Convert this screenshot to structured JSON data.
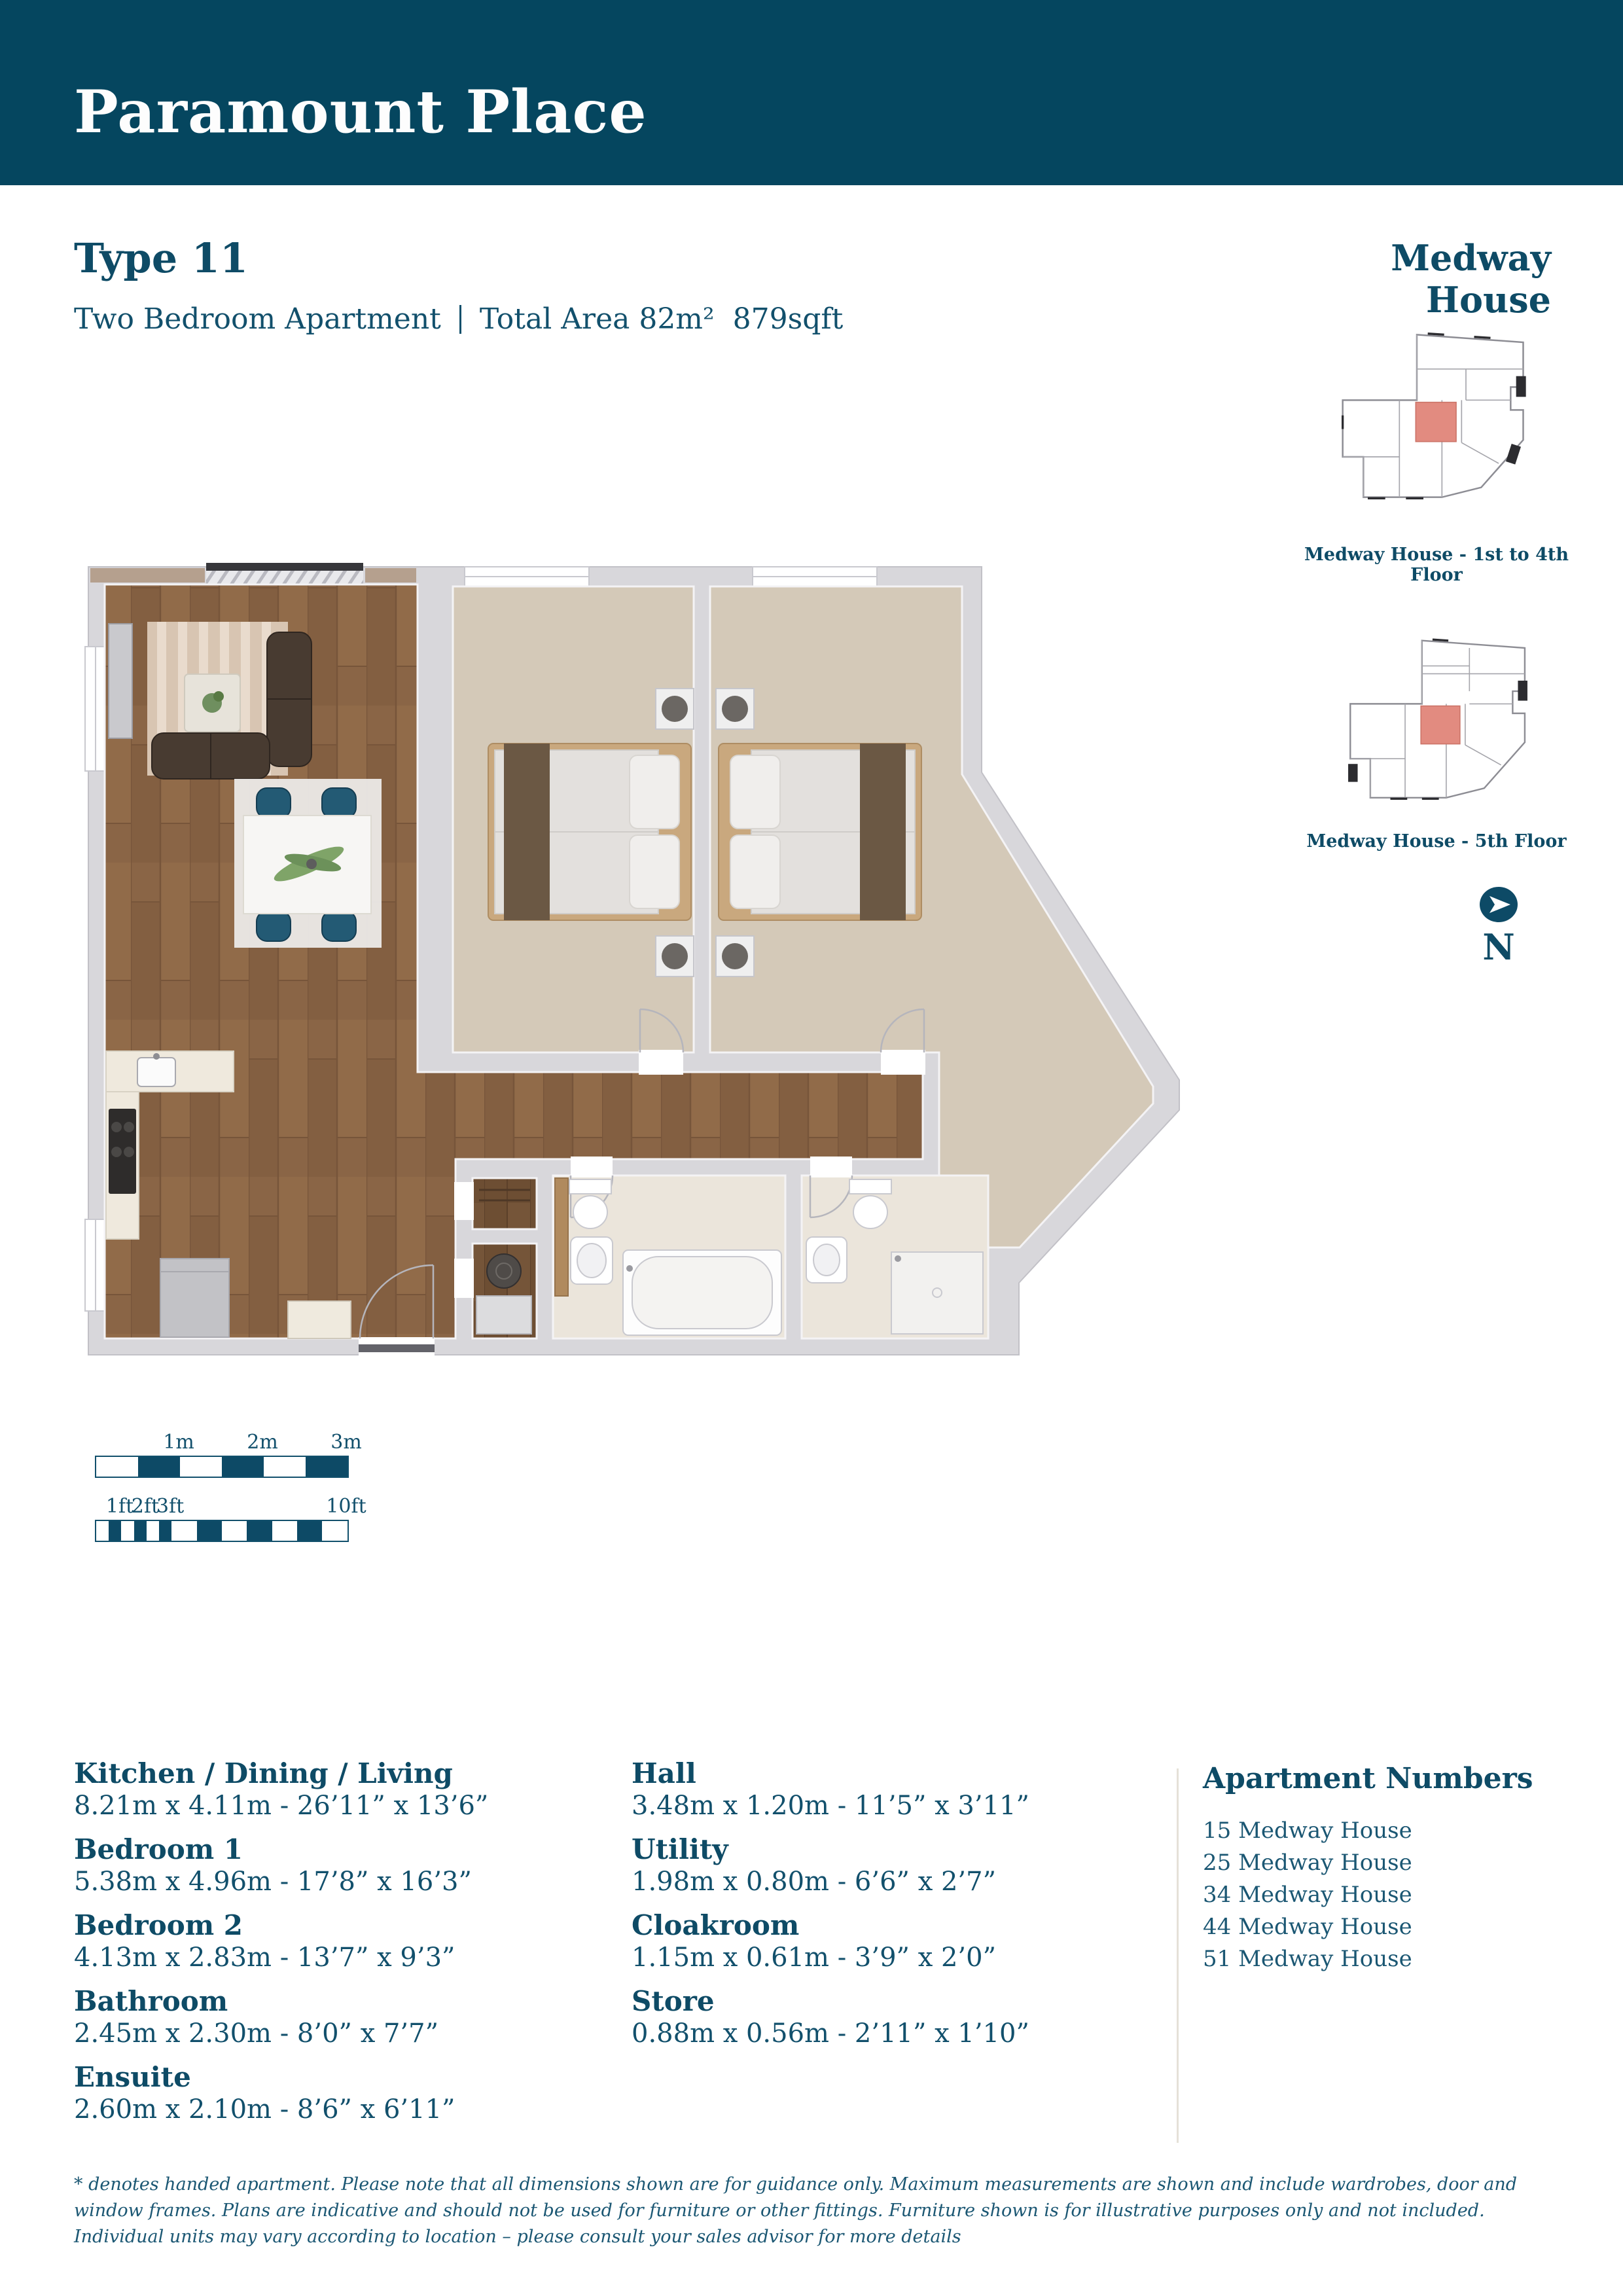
{
  "header": {
    "title": "Paramount Place"
  },
  "unit": {
    "type_label": "Type 11",
    "bedrooms_label": "Two Bedroom Apartment",
    "total_area_label": "Total Area 82m²",
    "sqft_label": "879sqft"
  },
  "locator": {
    "building_title": "Medway House",
    "captions": [
      "Medway House - 1st to 4th Floor",
      "Medway House - 5th Floor"
    ],
    "highlight_color": "#e28b80"
  },
  "north": {
    "label": "N"
  },
  "scale": {
    "m_labels": [
      "1m",
      "2m",
      "3m"
    ],
    "ft_labels": [
      "1ft",
      "2ft",
      "3ft",
      "10ft"
    ]
  },
  "rooms_col1": [
    {
      "name": "Kitchen / Dining / Living",
      "dims": "8.21m x 4.11m  -  26’11” x 13’6”"
    },
    {
      "name": "Bedroom 1",
      "dims": "5.38m x 4.96m  -  17’8” x 16’3”"
    },
    {
      "name": "Bedroom 2",
      "dims": "4.13m x 2.83m  -  13’7” x 9’3”"
    },
    {
      "name": "Bathroom",
      "dims": "2.45m x 2.30m  -  8’0” x 7’7”"
    },
    {
      "name": "Ensuite",
      "dims": "2.60m x 2.10m  -  8’6” x 6’11”"
    }
  ],
  "rooms_col2": [
    {
      "name": "Hall",
      "dims": "3.48m x 1.20m  -  11’5” x 3’11”"
    },
    {
      "name": "Utility",
      "dims": "1.98m x 0.80m  -  6’6” x 2’7”"
    },
    {
      "name": "Cloakroom",
      "dims": "1.15m x 0.61m  -  3’9” x 2’0”"
    },
    {
      "name": "Store",
      "dims": "0.88m x 0.56m  -  2’11” x 1’10”"
    }
  ],
  "apartments": {
    "title": "Apartment Numbers",
    "items": [
      "15 Medway House",
      "25 Medway House",
      "34 Medway House",
      "44 Medway House",
      "51 Medway House"
    ]
  },
  "footer": {
    "text": "* denotes handed apartment. Please note that all dimensions shown are for guidance only. Maximum measurements are shown and include wardrobes, door and window frames. Plans are indicative and should not be used for furniture or other fittings. Furniture shown is for illustrative purposes only and not included. Individual units may vary according to location – please consult your sales advisor for more details"
  },
  "colors": {
    "header_bg": "#05465f",
    "accent_teal": "#0e4b66",
    "body_teal": "#12506c",
    "highlight_salmon": "#e28b80",
    "wall_gray": "#d8d7db",
    "wood": "#8a6546",
    "carpet": "#d4c9b8"
  }
}
